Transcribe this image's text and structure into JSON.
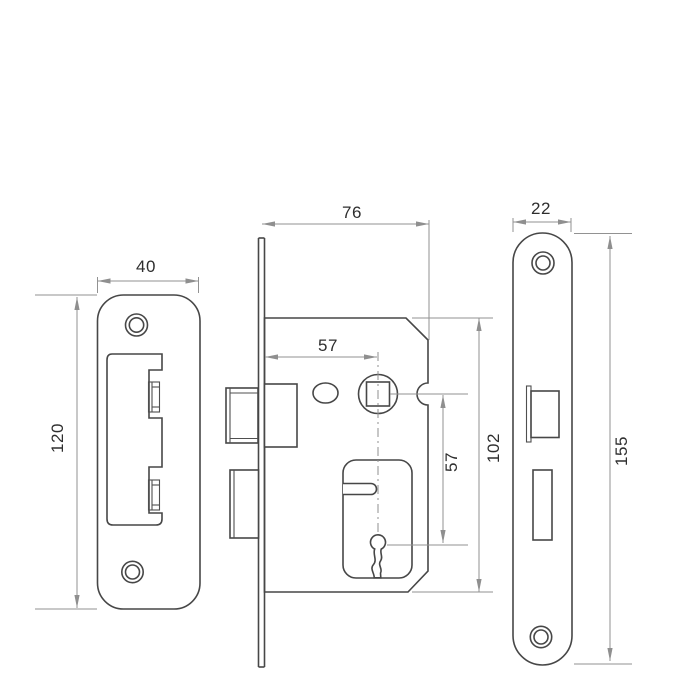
{
  "drawing": {
    "subject": "Mortice sash lock technical dimension drawing",
    "views": {
      "left": "strike plate front view",
      "center": "lock case side view",
      "right": "faceplate front view"
    },
    "colors": {
      "background": "#ffffff",
      "object_line": "#474747",
      "dimension_line": "#929292",
      "text": "#2e2e2e"
    },
    "dimensions": {
      "strike_plate_width": "40",
      "strike_plate_height": "120",
      "case_depth": "76",
      "backset": "57",
      "case_height": "102",
      "spindle_to_keyhole": "57",
      "faceplate_width": "22",
      "faceplate_height": "155"
    }
  }
}
